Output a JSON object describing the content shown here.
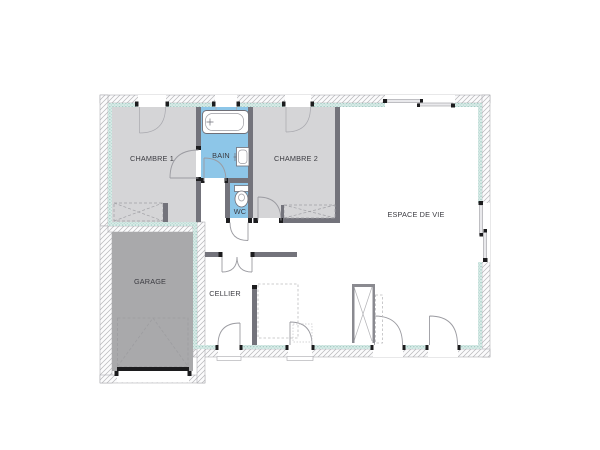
{
  "plan_title": "house-floor-plan",
  "rooms": {
    "chambre1": {
      "label": "CHAMBRE 1"
    },
    "bain": {
      "label": "BAIN"
    },
    "chambre2": {
      "label": "CHAMBRE 2"
    },
    "espace_de_vie": {
      "label": "ESPACE DE VIE"
    },
    "wc": {
      "label": "WC"
    },
    "garage": {
      "label": "GARAGE"
    },
    "cellier": {
      "label": "CELLIER"
    }
  },
  "fixtures": [
    "bathtub",
    "washbasin",
    "toilet",
    "wardrobe-chambre1",
    "wardrobe-chambre2",
    "storage-closet",
    "kitchen-counter-dashed",
    "entry-mat",
    "garage-door",
    "double-swing-door",
    "sliding-bay-window"
  ],
  "colors": {
    "room_fill": "#d5d5d7",
    "garage_fill": "#a9a9ab",
    "wet_room_fill": "#8dc6e8",
    "interior_wall": "#73737b",
    "insulation_band": "#d9ece8",
    "insulation_dot": "#9ec7c0",
    "hatch_line": "#b6b6b9",
    "line": "#9b9ba1",
    "jamb_black": "#1c1c1e",
    "text": "#3b3b41",
    "background": "#ffffff"
  }
}
